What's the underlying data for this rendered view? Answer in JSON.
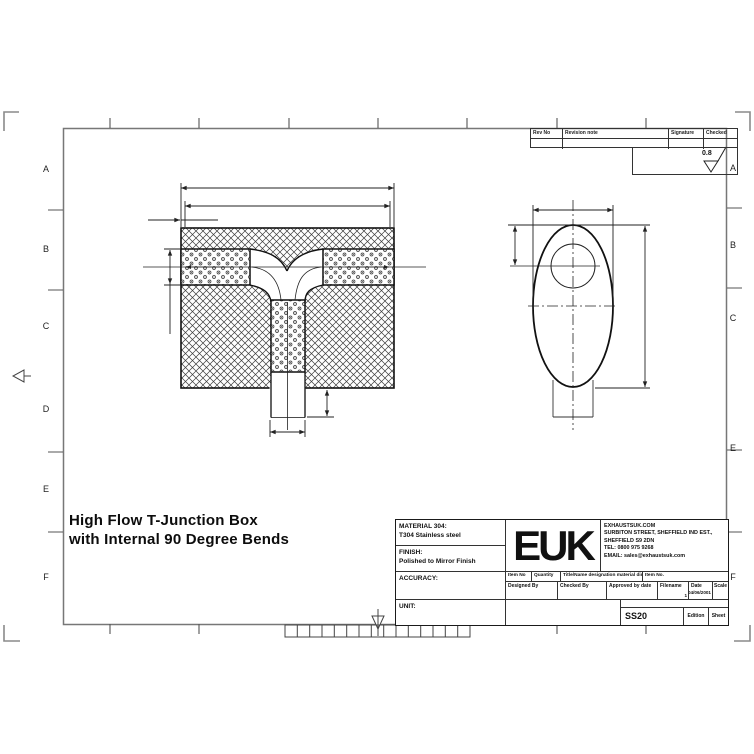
{
  "sheet": {
    "title_line1": "High Flow T-Junction Box",
    "title_line2": "with Internal 90 Degree Bends"
  },
  "zones": {
    "left": [
      "A",
      "B",
      "C",
      "D",
      "E",
      "F"
    ],
    "right": [
      "A",
      "B",
      "C",
      "E",
      "F"
    ]
  },
  "revision_table": {
    "rev_no": "Rev No",
    "revision_note": "Revision note",
    "signature": "Signature",
    "checked": "Checked"
  },
  "surface_finish": {
    "roughness": "0.8"
  },
  "title_block": {
    "material_label": "MATERIAL 304:",
    "material_value": "T304 Stainless steel",
    "finish_label": "FINISH:",
    "finish_value": "Polished to Mirror Finish",
    "accuracy_label": "ACCURACY:",
    "unit_label": "UNIT:",
    "logo_text": "EUK",
    "company": {
      "line1": "EXHAUSTSUK.COM",
      "line2": "SURBITON STREET, SHEFFIELD IND EST.,",
      "line3": "SHEFFIELD S9 2DN",
      "line4": "TEL: 0800 975 9268",
      "line5": "EMAIL: sales@exhaustsuk.com"
    },
    "item_row": {
      "item_no": "Item No",
      "quantity": "Quantity",
      "designation": "Title/Name designation material dimensions",
      "item_no2": "Item No."
    },
    "sign_row": {
      "designed_by": "Designed By",
      "checked_by": "Checked By",
      "approved": "Approved by date",
      "filename": "Filename",
      "filename_value": "1",
      "date_label": "Date",
      "date_value": "04/06/2001",
      "scale_label": "Scale"
    },
    "part_number": "SS20",
    "edition_label": "Edition",
    "sheet_label": "Sheet"
  },
  "colors": {
    "line": "#1a1a1a",
    "frame": "#777777",
    "background": "#ffffff"
  }
}
